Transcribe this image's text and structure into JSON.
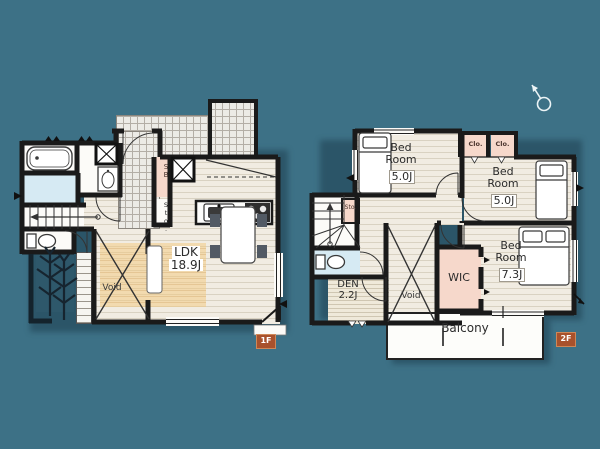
{
  "colors": {
    "background": "#3D7186",
    "wall": "#1a1a1a",
    "floor": "#f1ece2",
    "tile": "#ecebe6",
    "pink_closet": "#f6d8cb",
    "blue_sanitary": "#d6eaf3",
    "rug": "#f3c77c",
    "badge": "#a8512c",
    "balcony": "#fdfdfa"
  },
  "floor1": {
    "badge": "1F",
    "ldk": {
      "label": "LDK",
      "size": "18.9J"
    },
    "void_label": "Void",
    "shoe_box_label": "SB",
    "storage_label": "Sto."
  },
  "floor2": {
    "badge": "2F",
    "bedrooms": [
      {
        "label": "Bed Room",
        "size": "5.0J"
      },
      {
        "label": "Bed Room",
        "size": "5.0J"
      },
      {
        "label": "Bed Room",
        "size": "7.3J"
      }
    ],
    "den": {
      "label": "DEN",
      "size": "2.2J"
    },
    "wic_label": "WIC",
    "void_label": "Void",
    "balcony_label": "Balcony",
    "storage_label": "Sto.",
    "closet1_label": "Clo.",
    "closet2_label": "Clo."
  }
}
